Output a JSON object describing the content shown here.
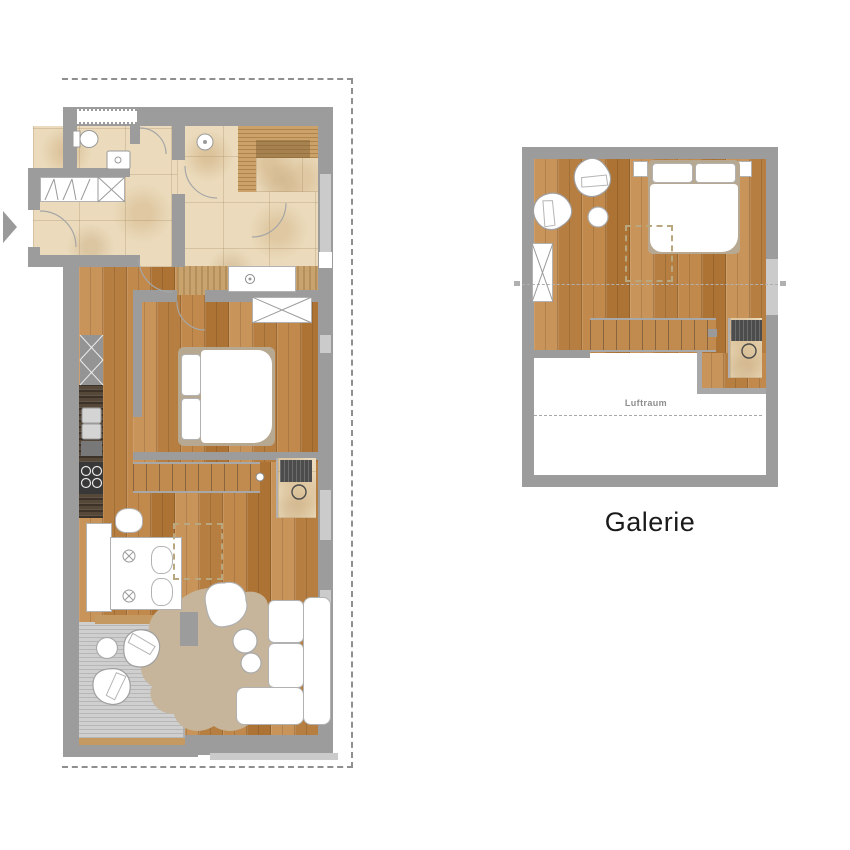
{
  "page": {
    "background": "#ffffff"
  },
  "labels": {
    "galerie": "Galerie",
    "luftraum": "Luftraum"
  },
  "icons": {
    "entrance_arrow": "right-pointing-triangle"
  },
  "colors": {
    "wall": "#9c9c9c",
    "wall_window": "#cbcbcb",
    "tile": "#ebdbbc",
    "wood": "#c18a4f",
    "wood_dark": "#b07a3e",
    "deck": "#c6c6c6",
    "rug": "#c6b59a",
    "slats": "#c79e66",
    "counter": "#564839",
    "appliance": "#4c4c4c",
    "furniture_border": "#b2b2b2",
    "line": "#a0a0a0",
    "boundary": "#8f8f8f",
    "label": "#1a1a1a",
    "muted_label": "#8d8d8d",
    "arrow": "#9a9a9a"
  },
  "plans": {
    "main": {
      "elements": [
        "entry-hall",
        "wardrobe",
        "guest-wc",
        "bathroom",
        "sauna-bench",
        "vanity",
        "bedroom",
        "double-bed",
        "built-in-closet",
        "kitchen-line",
        "sideboard",
        "dining-table",
        "dining-chairs",
        "staircase",
        "desk-nook",
        "living-area",
        "l-shaped-sofa",
        "rug",
        "coffee-tables",
        "beanbag",
        "balcony-deck",
        "lounge-chairs",
        "balcony-table"
      ]
    },
    "galerie": {
      "elements": [
        "sleeping-area",
        "double-bed",
        "nightstands",
        "armchairs",
        "side-table",
        "wardrobe",
        "staircase",
        "desk-nook",
        "air-space-void"
      ]
    }
  }
}
